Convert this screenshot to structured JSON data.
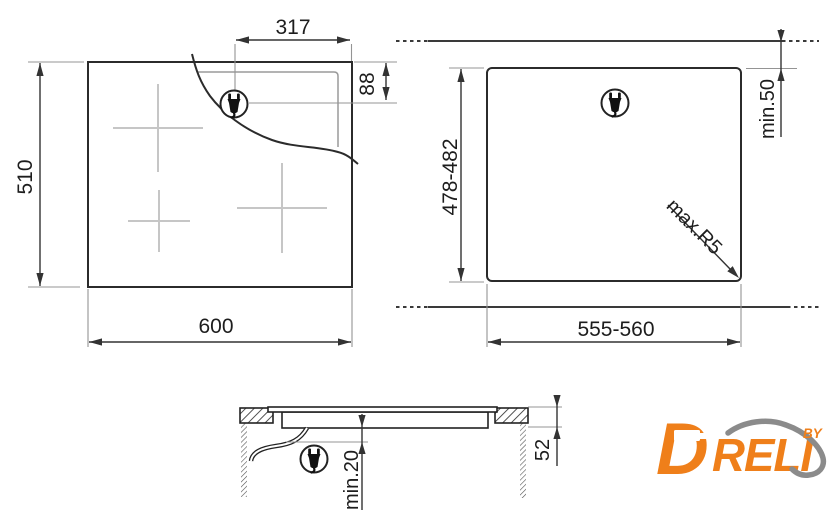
{
  "title": "Built-in hob installation diagram",
  "colors": {
    "main_line": "#2b2b2b",
    "aux_line": "#949494",
    "burner_marker": "#c6c6c6",
    "logo_orange": "#EF7F1A",
    "logo_gray": "#8B8B8B"
  },
  "top_view": {
    "width": "600",
    "height": "510",
    "plug_x": "317",
    "plug_y": "88"
  },
  "cutout_view": {
    "width": "555-560",
    "depth": "478-482",
    "min_rear": "min.50",
    "max_radius": "max.R5"
  },
  "side_view": {
    "recess_depth": "52",
    "min_clearance": "min.20"
  },
  "logo": {
    "initial": "D",
    "rest": "RELI",
    "by": "BY"
  }
}
